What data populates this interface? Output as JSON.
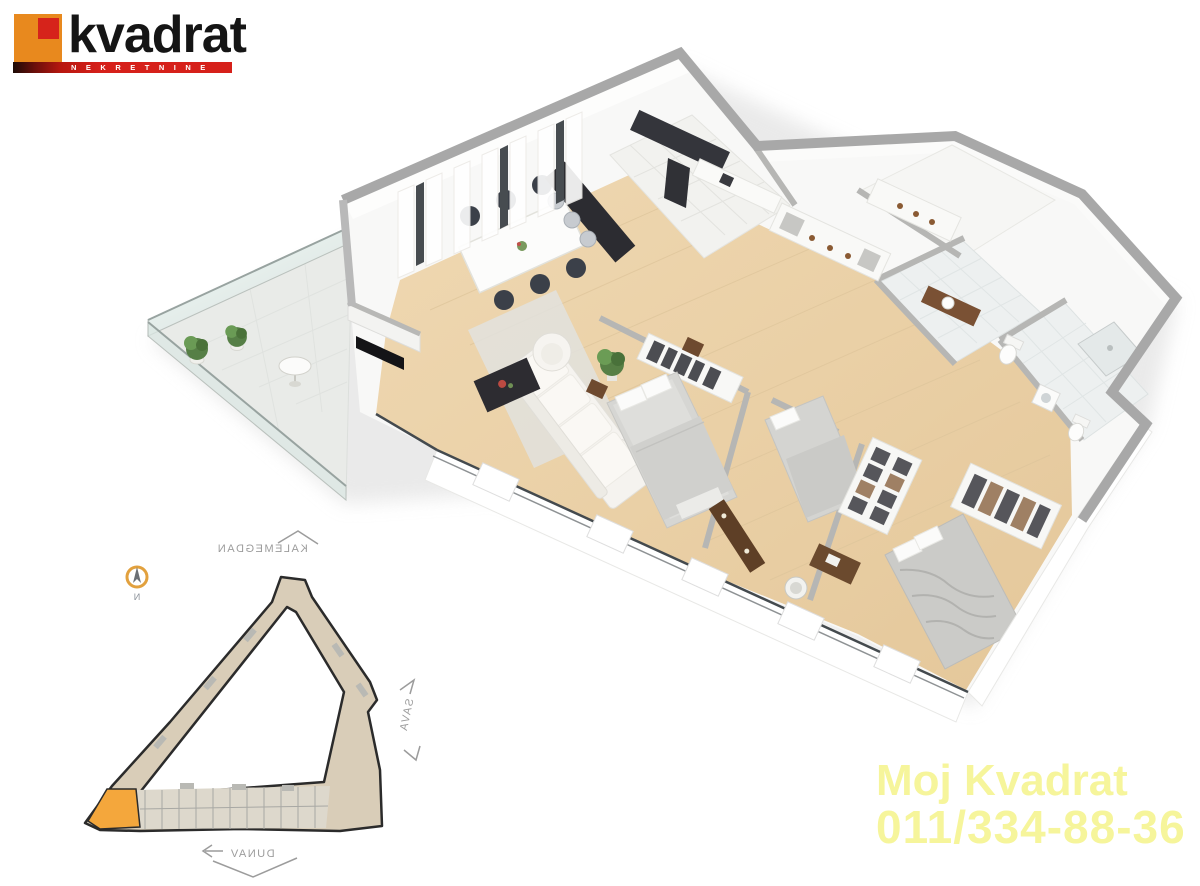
{
  "logo": {
    "brand": "kvadrat",
    "tagline": "NEKRETNINE"
  },
  "contact": {
    "name": "Moj Kvadrat",
    "phone": "011/334-88-36"
  },
  "site_map": {
    "label_top": "KALEMEGDAN",
    "label_right": "SAVA",
    "label_bottom": "DUNAV",
    "compass_label": "N"
  },
  "colors": {
    "brand_orange": "#e8891e",
    "brand_red": "#d6231b",
    "contact_yellow": "#f6f59b",
    "map_building": "#d9cdb8",
    "map_unit_highlight": "#f4a73c",
    "map_outline": "#2b2b2b",
    "floor_wood": "#ecd3a9",
    "wall_gray": "#a8a8a8",
    "tile_white": "#f2f2ef"
  }
}
